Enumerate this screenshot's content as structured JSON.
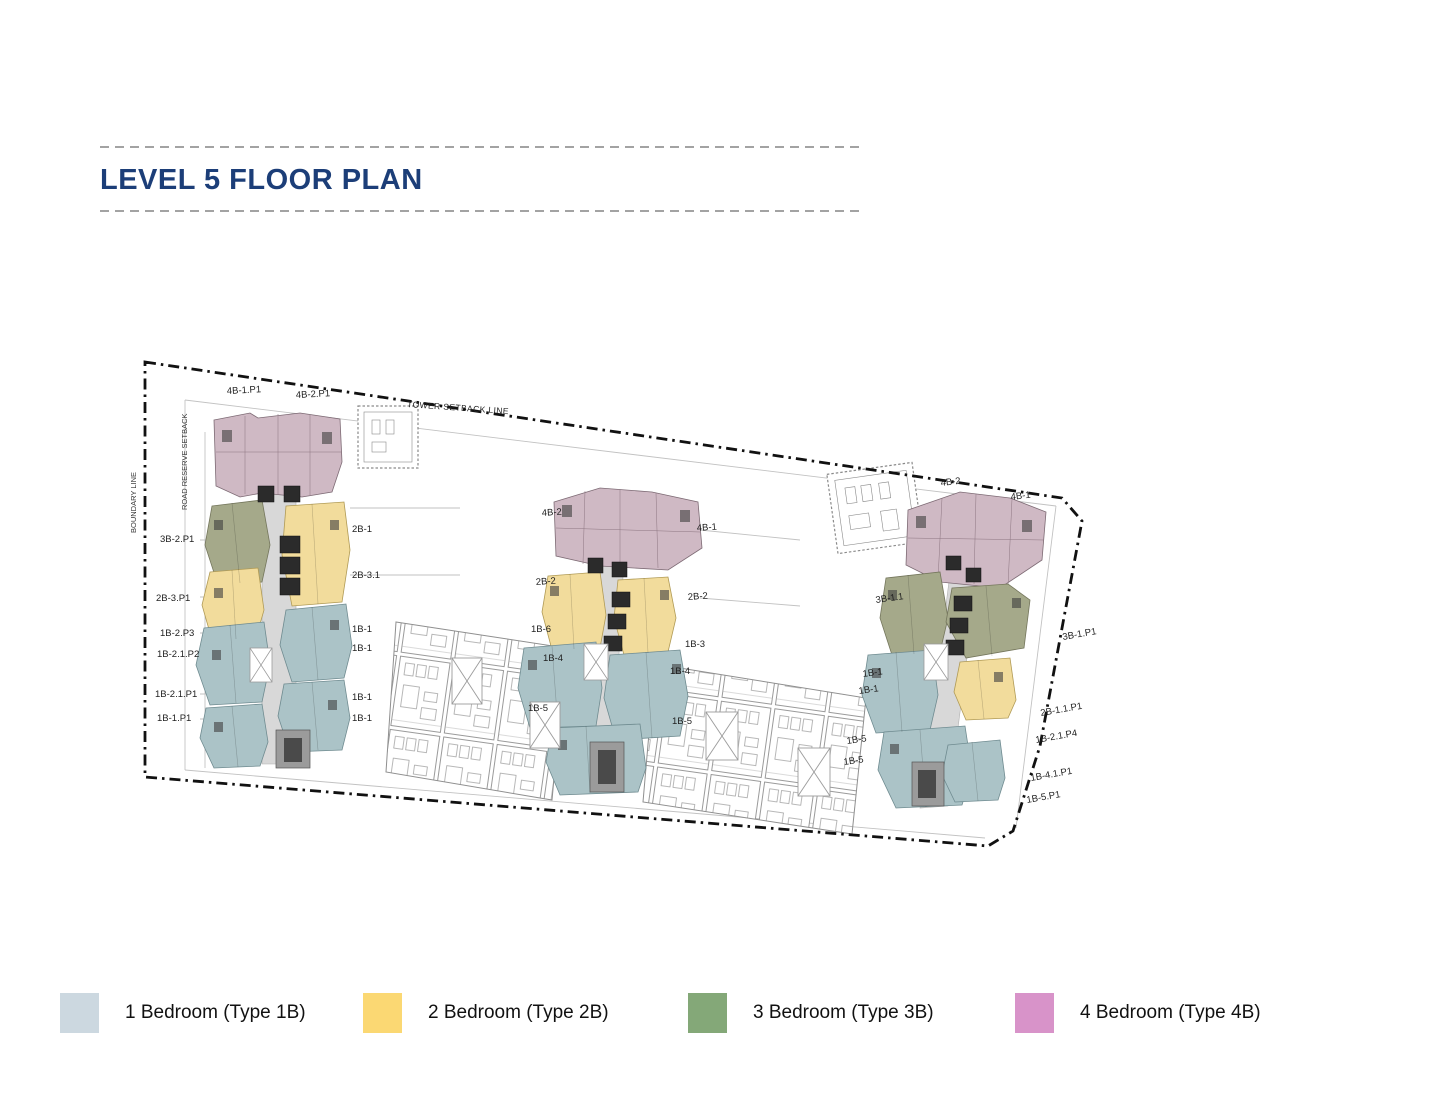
{
  "page": {
    "title": "LEVEL 5 FLOOR PLAN",
    "footer_clipped_label": "L5 TOWER PLAN"
  },
  "colors": {
    "title_navy": "#1c3e78",
    "legend_1b": "#ccd8e0",
    "legend_2b": "#fbd873",
    "legend_3b": "#84a878",
    "legend_4b": "#d893c9",
    "plan_1b": "#abc3c7",
    "plan_2b": "#f2dc9c",
    "plan_3b": "#a5a98a",
    "plan_4b": "#cfb9c4",
    "boundary_line": "#111111"
  },
  "legend": {
    "items": [
      {
        "label": "1 Bedroom (Type 1B)",
        "color": "#ccd8e0"
      },
      {
        "label": "2 Bedroom (Type 2B)",
        "color": "#fbd873"
      },
      {
        "label": "3 Bedroom (Type 3B)",
        "color": "#84a878"
      },
      {
        "label": "4 Bedroom (Type 4B)",
        "color": "#d893c9"
      }
    ]
  },
  "plan": {
    "site_labels": {
      "tower_setback": "TOWER SETBACK LINE",
      "boundary": "BOUNDARY LINE",
      "road_reserve": "ROAD RESERVE SETBACK"
    },
    "unit_labels": [
      "4B-1.P1",
      "4B-2.P1",
      "3B-2.P1",
      "2B-3.P1",
      "1B-2.P3",
      "1B-2.1.P2",
      "1B-2.1.P1",
      "1B-1.P1",
      "2B-1",
      "2B-3.1",
      "1B-1",
      "1B-1",
      "1B-1",
      "1B-1",
      "4B-2",
      "4B-1",
      "2B-2",
      "2B-2",
      "1B-6",
      "1B-3",
      "1B-4",
      "1B-4",
      "1B-5",
      "1B-5",
      "4B-2",
      "4B-1",
      "3B-1.1",
      "3B-1.P1",
      "1B-1",
      "1B-1",
      "1B-5",
      "1B-5",
      "2B-1.1.P1",
      "1B-2.1.P4",
      "1B-4.1.P1",
      "1B-5.P1"
    ]
  }
}
